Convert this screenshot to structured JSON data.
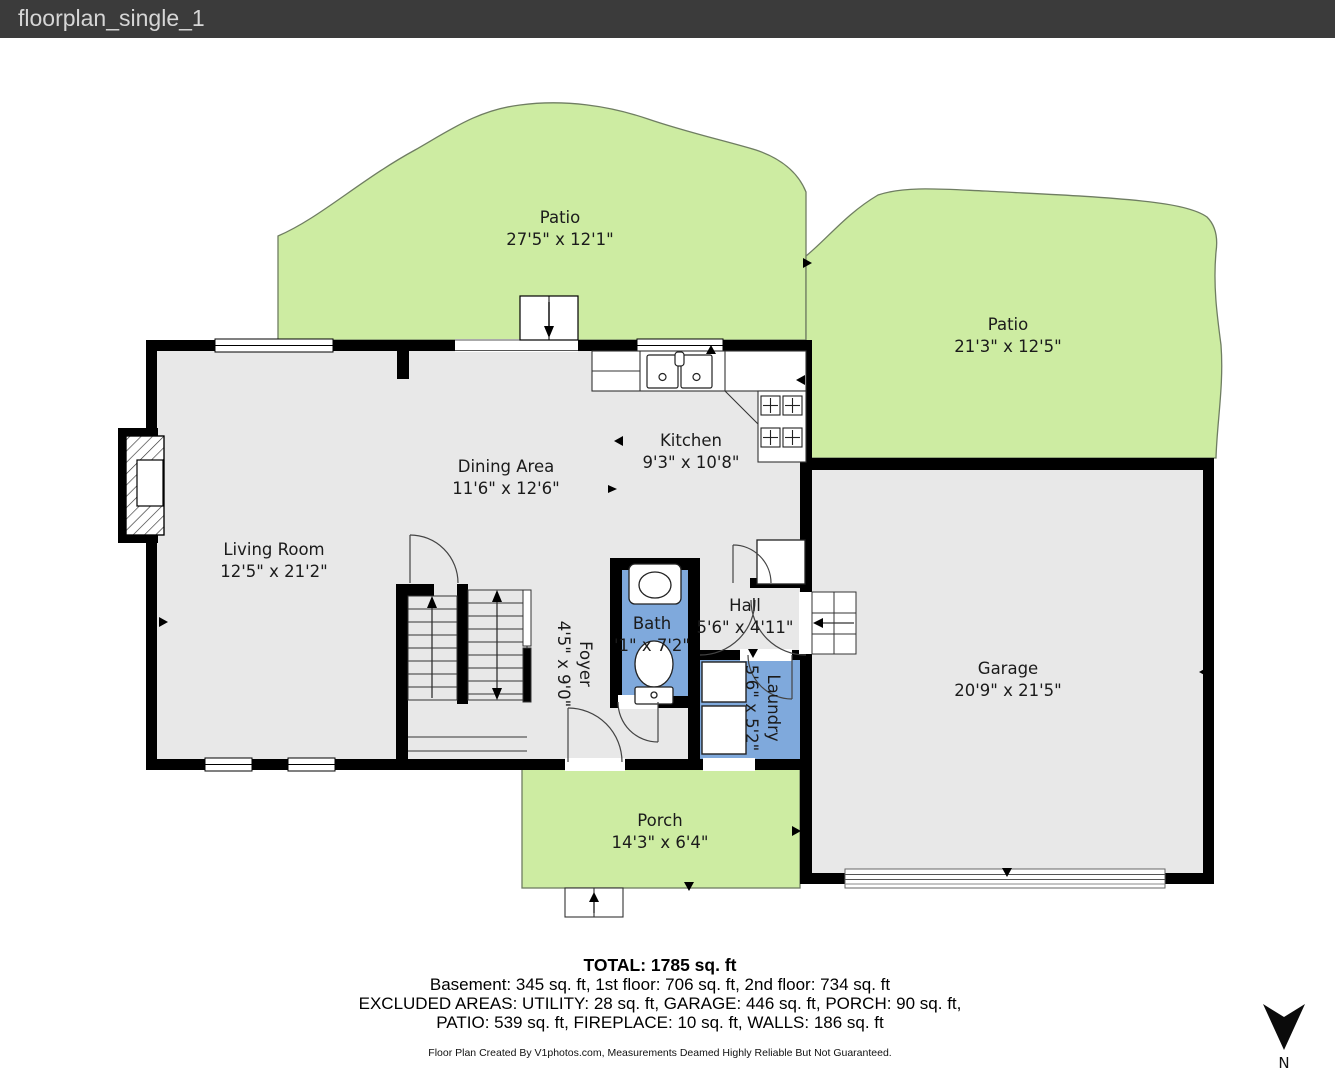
{
  "header": {
    "title": "floorplan_single_1"
  },
  "rooms": {
    "patio_top_left": {
      "name": "Patio",
      "dims": "27'5\" x 12'1\""
    },
    "patio_top_right": {
      "name": "Patio",
      "dims": "21'3\" x 12'5\""
    },
    "kitchen": {
      "name": "Kitchen",
      "dims": "9'3\" x 10'8\""
    },
    "dining": {
      "name": "Dining Area",
      "dims": "11'6\" x 12'6\""
    },
    "living": {
      "name": "Living Room",
      "dims": "12'5\" x 21'2\""
    },
    "bath": {
      "name": "Bath",
      "dims": "'1\" x 7'2\""
    },
    "hall": {
      "name": "Hall",
      "dims": "5'6\" x 4'11\""
    },
    "foyer": {
      "name": "Foyer",
      "dims": "4'5\" x 9'0\""
    },
    "laundry": {
      "name": "Laundry",
      "dims": "5'6\" x 5'2\""
    },
    "garage": {
      "name": "Garage",
      "dims": "20'9\" x 21'5\""
    },
    "porch": {
      "name": "Porch",
      "dims": "14'3\" x 6'4\""
    }
  },
  "summary": {
    "total": "TOTAL: 1785 sq. ft",
    "line2": "Basement: 345 sq. ft, 1st floor: 706 sq. ft, 2nd floor: 734 sq. ft",
    "line3": "EXCLUDED AREAS: UTILITY: 28 sq. ft, GARAGE: 446 sq. ft, PORCH: 90 sq. ft,",
    "line4": "PATIO: 539 sq. ft, FIREPLACE: 10 sq. ft, WALLS: 186 sq. ft",
    "credit": "Floor Plan Created By V1photos.com, Measurements Deamed Highly Reliable But Not Guaranteed."
  },
  "compass": {
    "label": "N"
  },
  "colors": {
    "header_bg": "#3b3b3b",
    "patio_green": "#cdeca2",
    "floor_gray": "#e8e8e8",
    "wet_room_blue": "#7fa9dc",
    "wall_black": "#000000"
  }
}
